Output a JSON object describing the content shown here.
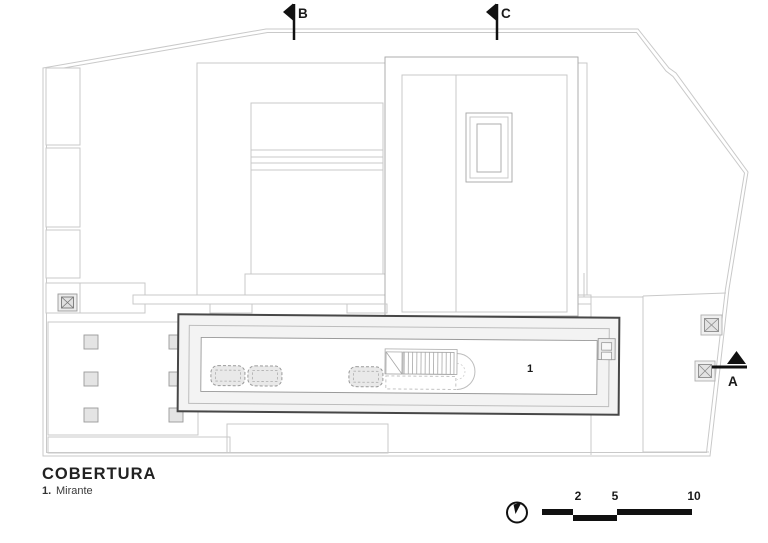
{
  "drawing": {
    "title": "COBERTURA",
    "legend_items": [
      {
        "number": "1.",
        "label": "Mirante"
      }
    ],
    "rooms": [
      {
        "number": "1"
      }
    ],
    "section_markers": [
      {
        "label": "B"
      },
      {
        "label": "C"
      },
      {
        "label": "A"
      }
    ],
    "scale_bar": {
      "tick_labels": [
        "2",
        "5",
        "10"
      ]
    },
    "icons": {
      "north_arrow": "north-arrow-icon",
      "column_marker": "column-marker-icon",
      "section_cut": "section-cut-icon",
      "skylight_opening": "skylight-opening",
      "stair": "stair-run"
    },
    "colors": {
      "ink": "#111111",
      "line_light": "#c9c9c9",
      "line_medium": "#9a9a9a",
      "mirante_outline": "#474747",
      "panel_fill": "#f3f3f3",
      "hatch_fill": "#e6e6e6"
    }
  }
}
